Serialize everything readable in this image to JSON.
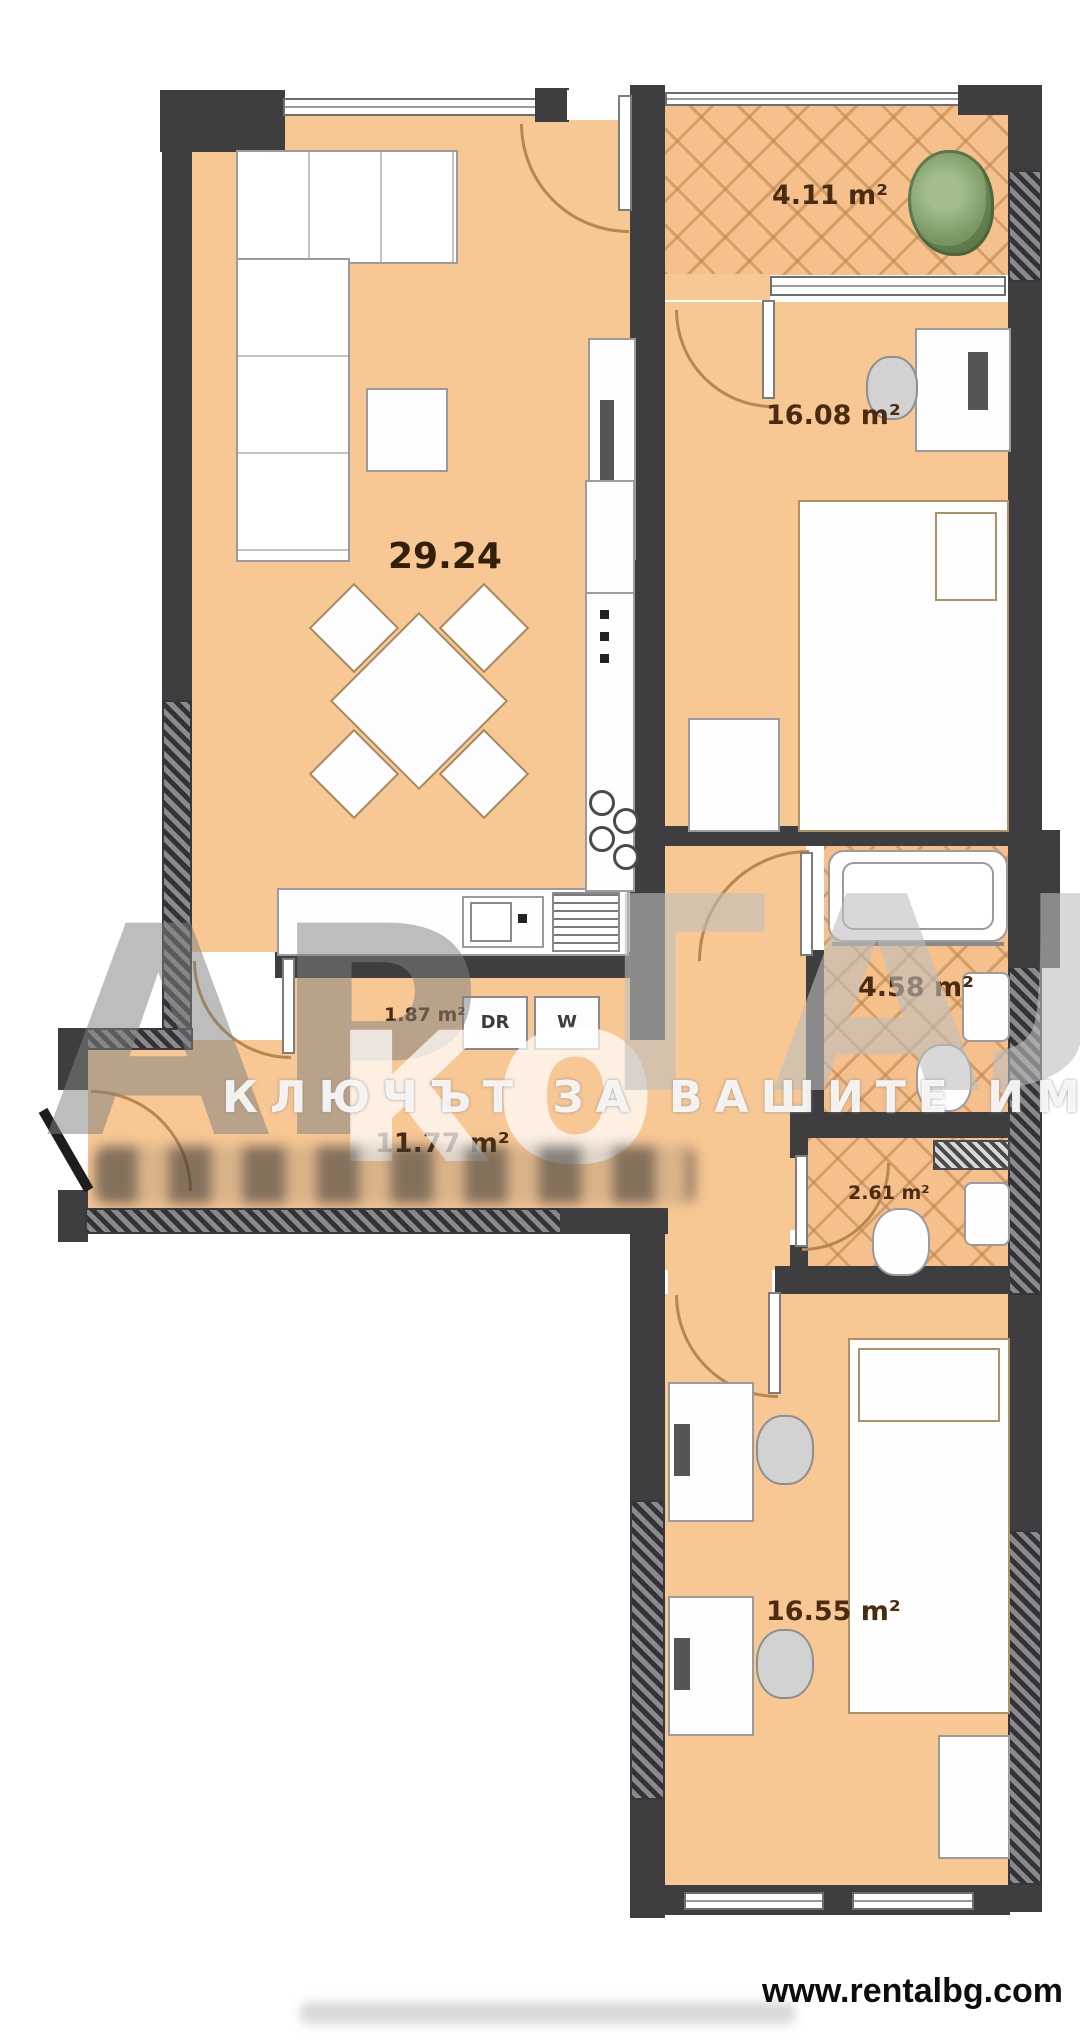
{
  "watermark": {
    "left_letters": "АР",
    "middle_letters": "ко",
    "right_letters": "ГАЛ",
    "tagline": "КЛЮЧЪТ ЗА ВАШИТЕ ИМОТИ"
  },
  "footer": {
    "site_url": "www.rentalbg.com"
  },
  "rooms": {
    "living": {
      "area_label": "29.24"
    },
    "balcony": {
      "area_label": "4.11 m²"
    },
    "bedroom1": {
      "area_label": "16.08 m²"
    },
    "bathroom": {
      "area_label": "4.58 m²"
    },
    "laundry": {
      "area_label": "1.87 m²",
      "dryer_label": "DR",
      "washer_label": "W"
    },
    "hallway": {
      "area_label": "11.77 m²"
    },
    "wc": {
      "area_label": "2.61 m²"
    },
    "bedroom2": {
      "area_label": "16.55 m²"
    }
  },
  "colors": {
    "floor": "#f7c794",
    "tile_floor": "#f5c08c",
    "wall": "#3e3e40",
    "tile_line": "#b9824b",
    "label_text": "#4a2c12",
    "door_arc": "#b8874d",
    "watermark_gray": "#9e9e9e"
  }
}
